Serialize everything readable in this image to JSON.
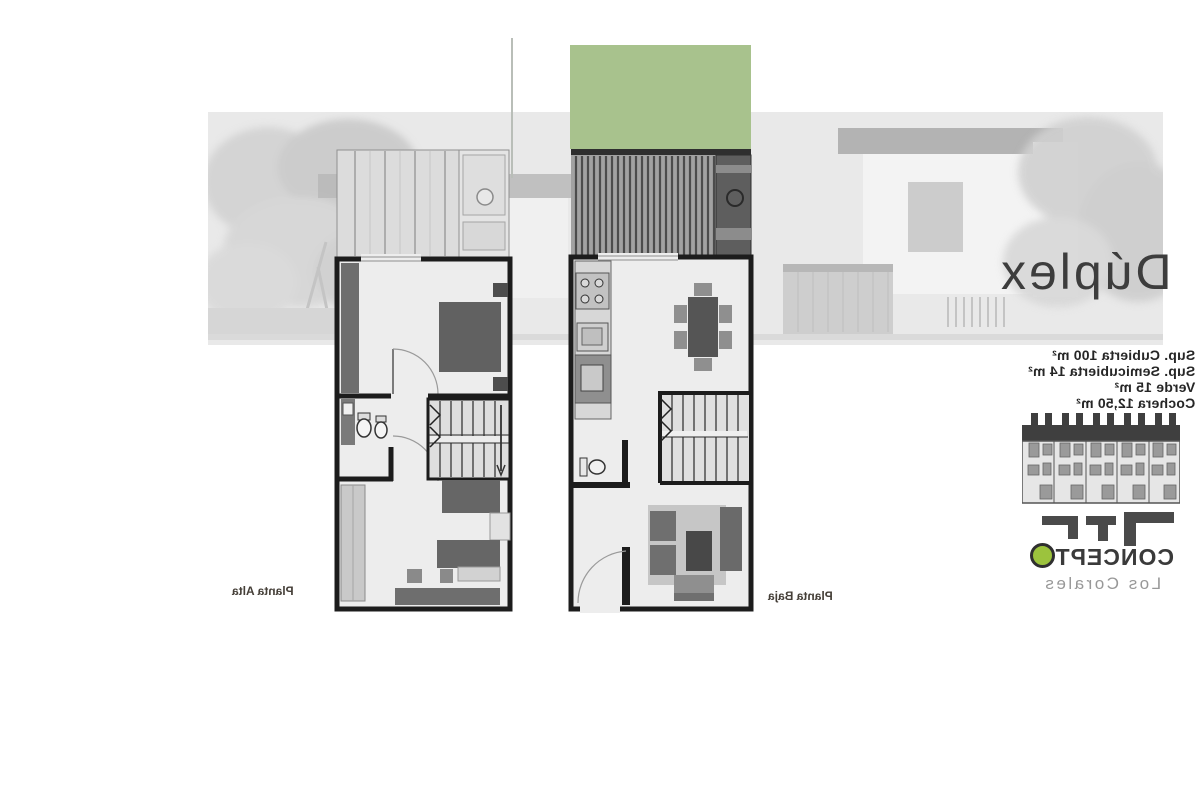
{
  "title": "Dúplex",
  "specs": {
    "lines": [
      "Sup. Cubierta 100 m²",
      "Sup. Semicubierta 14 m²",
      "Verde 15 m²",
      "Cochera 12,50 m²"
    ]
  },
  "plans": {
    "upper": {
      "label": "Planta Alta"
    },
    "lower": {
      "label": "Planta Baja"
    }
  },
  "brand": {
    "name_main": "CONCEPT",
    "name_o": "O",
    "tagline": "Los Corales",
    "accent_green": "#9cc33d"
  },
  "colors": {
    "garden_green": "#a8c28d",
    "wall_dark": "#1c1c1c",
    "furniture_gray": "#666666",
    "render_band_gray": "#e9e9e9"
  }
}
